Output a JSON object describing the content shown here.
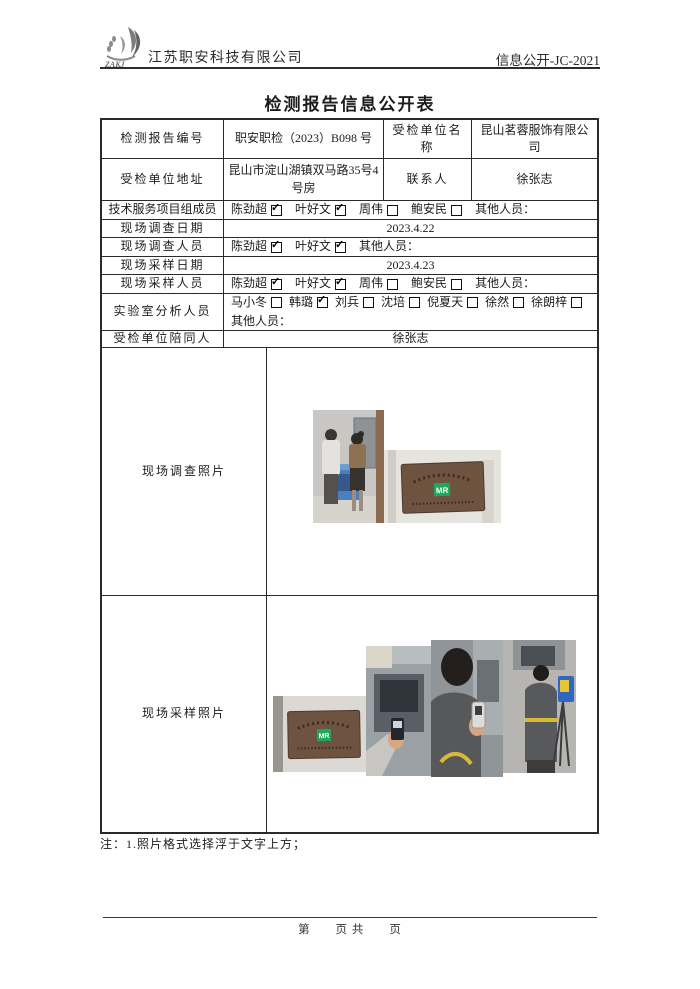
{
  "header": {
    "logo_text": "ZAKJ",
    "company": "江苏职安科技有限公司",
    "doc_code": "信息公开-JC-2021"
  },
  "title": "检测报告信息公开表",
  "table": {
    "report_no": {
      "label": "检测报告编号",
      "value": "职安职检（2023）B098 号"
    },
    "unit_name": {
      "label": "受检单位名称",
      "value": "昆山茗蓉服饰有限公司"
    },
    "unit_addr": {
      "label": "受检单位地址",
      "value": "昆山市淀山湖镇双马路35号4号房"
    },
    "contact": {
      "label": "联系人",
      "value": "徐张志"
    },
    "tech_team": {
      "label": "技术服务项目组成员",
      "members": [
        {
          "name": "陈劲超",
          "checked": true
        },
        {
          "name": "叶好文",
          "checked": true
        },
        {
          "name": "周伟",
          "checked": false
        },
        {
          "name": "鲍安民",
          "checked": false
        }
      ],
      "other": "其他人员："
    },
    "survey_date": {
      "label": "现场调查日期",
      "value": "2023.4.22"
    },
    "survey_staff": {
      "label": "现场调查人员",
      "members": [
        {
          "name": "陈劲超",
          "checked": true
        },
        {
          "name": "叶好文",
          "checked": true
        }
      ],
      "other": "其他人员："
    },
    "sample_date": {
      "label": "现场采样日期",
      "value": "2023.4.23"
    },
    "sample_staff": {
      "label": "现场采样人员",
      "members": [
        {
          "name": "陈劲超",
          "checked": true
        },
        {
          "name": "叶好文",
          "checked": true
        },
        {
          "name": "周伟",
          "checked": false
        },
        {
          "name": "鲍安民",
          "checked": false
        }
      ],
      "other": "其他人员："
    },
    "lab_staff": {
      "label": "实验室分析人员",
      "members": [
        {
          "name": "马小冬",
          "checked": false
        },
        {
          "name": "韩璐",
          "checked": true
        },
        {
          "name": "刘兵",
          "checked": false
        },
        {
          "name": "沈培",
          "checked": false
        },
        {
          "name": "倪夏天",
          "checked": false
        },
        {
          "name": "徐然",
          "checked": false
        },
        {
          "name": "徐朗梓",
          "checked": false
        }
      ],
      "other": "其他人员："
    },
    "escort": {
      "label": "受检单位陪同人",
      "value": "徐张志"
    },
    "survey_photos": {
      "label": "现场调查照片"
    },
    "sample_photos": {
      "label": "现场采样照片"
    }
  },
  "photos": {
    "plaque_logo": "MR"
  },
  "note": "注：1.照片格式选择浮于文字上方；",
  "footer": {
    "page_text": "第　　页 共　　页"
  },
  "colors": {
    "plaque_brown": "#6d5340",
    "logo_green": "#1fa85c",
    "machine_blue": "#4d7fba"
  }
}
